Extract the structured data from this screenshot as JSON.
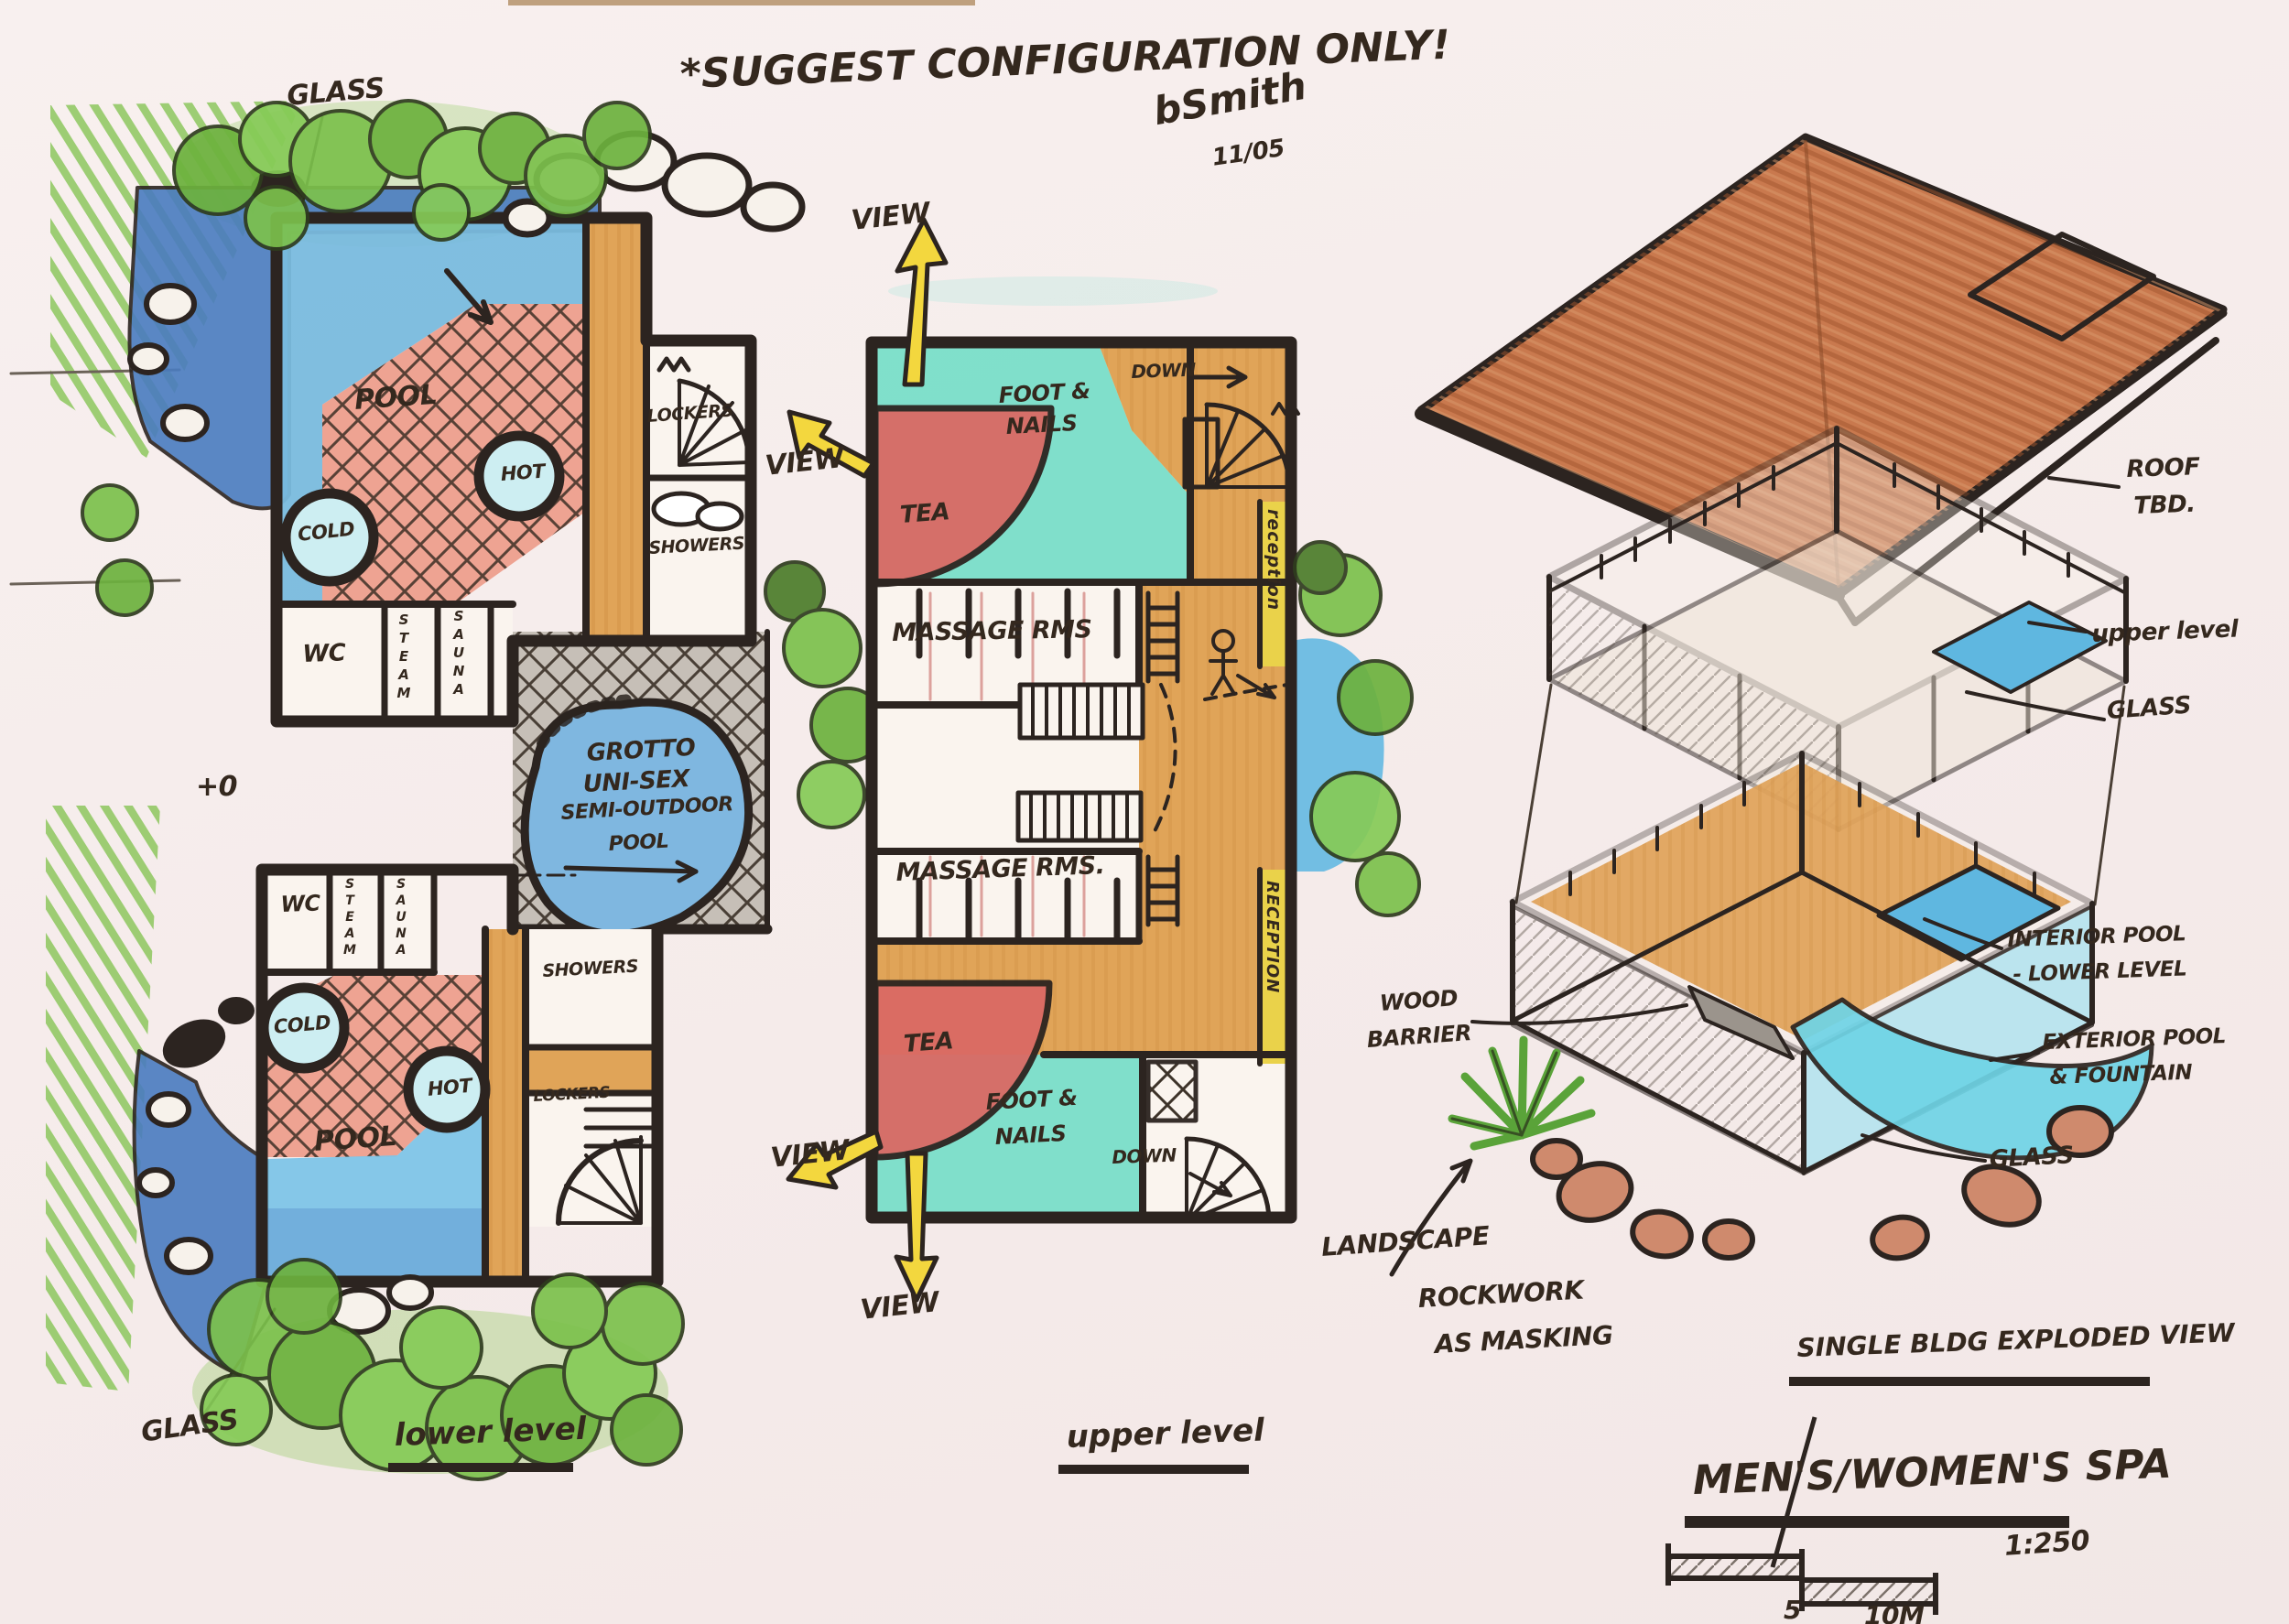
{
  "header": {
    "note": "*SUGGEST CONFIGURATION ONLY!",
    "signature": "bSmith",
    "date": "11/05"
  },
  "lower_level": {
    "title": "lower level",
    "glass_top": "GLASS",
    "glass_bottom": "GLASS",
    "datum": "+0",
    "upper_block": {
      "pool": "POOL",
      "cold": "COLD",
      "hot": "HOT",
      "lockers": "LOCKERS",
      "showers": "SHOWERS",
      "wc": "WC",
      "steam": "STEAM",
      "sauna": "SAUNA"
    },
    "grotto": {
      "line1": "GROTTO",
      "line2": "UNI-SEX",
      "line3": "SEMI-OUTDOOR",
      "line4": "POOL"
    },
    "lower_block": {
      "wc": "WC",
      "steam": "STEAM",
      "sauna": "SAUNA",
      "cold": "COLD",
      "hot": "HOT",
      "pool": "POOL",
      "showers": "SHOWERS",
      "lockers": "LOCKERS"
    }
  },
  "upper_level": {
    "title": "upper level",
    "view": "VIEW",
    "rooms": {
      "foot_nails_1": "FOOT &",
      "foot_nails_2": "NAILS",
      "tea": "TEA",
      "down": "DOWN",
      "reception_top": "reception",
      "reception_bottom": "RECEPTION",
      "massage_top": "MASSAGE RMS",
      "massage_bottom": "MASSAGE RMS."
    }
  },
  "exploded": {
    "title": "SINGLE BLDG EXPLODED VIEW",
    "roof_line1": "ROOF",
    "roof_line2": "TBD.",
    "upper_label": "upper level",
    "glass": "GLASS",
    "interior_line1": "INTERIOR POOL",
    "interior_line2": "- LOWER LEVEL",
    "exterior_line1": "EXTERIOR POOL",
    "exterior_line2": "& FOUNTAIN",
    "wood_line1": "WOOD",
    "wood_line2": "BARRIER",
    "land_line1": "LANDSCAPE",
    "land_line2": "ROCKWORK",
    "land_line3": "AS MASKING"
  },
  "titleblock": {
    "project": "MEN'S/WOMEN'S SPA",
    "scale": "1:250",
    "tick_5": "5",
    "tick_10": "10M"
  },
  "colors": {
    "paper": "#f6edec",
    "ink": "#2c2420",
    "pool_blue": "#79bade",
    "pond_blue": "#4a7cc0",
    "teal": "#79dec9",
    "deck_tan": "#e0a458",
    "deck_red": "#eea392",
    "tea_red": "#da6a64",
    "reception_yellow": "#ead24a",
    "tree_green": "#7cc14c",
    "roof_terracotta": "#c9794e",
    "rock_salmon": "#cf8a6d"
  }
}
